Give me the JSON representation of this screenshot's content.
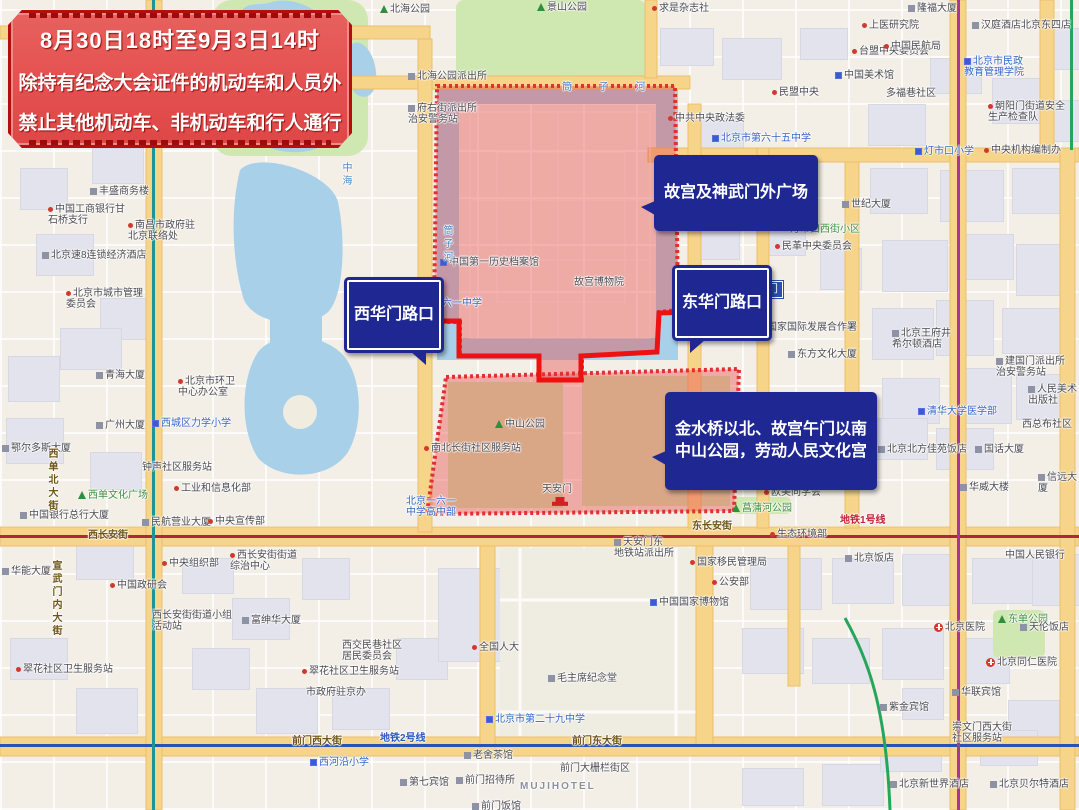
{
  "banner": {
    "line1": "8月30日18时至9月3日14时",
    "line2": "除持有纪念大会证件的机动车和人员外",
    "line3": "禁止其他机动车、非机动车和行人通行"
  },
  "callouts": {
    "xihuamen": "西华门路口",
    "donghuamen": "东华门路口",
    "gugong": "故宫及神武门外广场",
    "jinshui": "金水桥以北、故宫午门以南\n中山公园，劳动人民文化宫"
  },
  "colors": {
    "zone": "#e84c4c",
    "route": "#ee1111",
    "water": "#a9d0e9",
    "park": "#cfe7b0",
    "road": "#f6d489",
    "bubble": "#1e2792",
    "metro1": "#b0273a",
    "metro2": "#2a52b0",
    "metro4": "#1f939b",
    "metro5": "#a23a91",
    "metro8": "#26a65b"
  },
  "plates": [
    {
      "t": "东华门",
      "x": 740,
      "y": 281
    }
  ],
  "map": {
    "labels": [
      {
        "t": "求是杂志社",
        "x": 652,
        "y": 3,
        "ic": "dot"
      },
      {
        "t": "北海公园",
        "x": 380,
        "y": 4,
        "ic": "tree"
      },
      {
        "t": "景山公园",
        "x": 537,
        "y": 2,
        "ic": "tree"
      },
      {
        "t": "上医研究院",
        "x": 862,
        "y": 20,
        "ic": "dot"
      },
      {
        "t": "台盟中央委员会",
        "x": 852,
        "y": 46,
        "ic": "dot"
      },
      {
        "t": "隆福大厦",
        "x": 908,
        "y": 3,
        "ic": "gbld"
      },
      {
        "t": "汉庭酒店北京东四店",
        "x": 972,
        "y": 20,
        "ic": "gbld"
      },
      {
        "t": "中国民航局",
        "x": 884,
        "y": 41,
        "ic": "dot"
      },
      {
        "t": "民盟中央",
        "x": 772,
        "y": 87,
        "ic": "dot"
      },
      {
        "t": "中共中央政法委",
        "x": 668,
        "y": 113,
        "ic": "dot"
      },
      {
        "t": "北京市第六十五中学",
        "x": 712,
        "y": 133,
        "c": "blue",
        "ic": "bld"
      },
      {
        "t": "北海公园派出所",
        "x": 408,
        "y": 71,
        "ic": "gbld"
      },
      {
        "t": "筒 子 河",
        "x": 562,
        "y": 82,
        "c": "water",
        "ls": 12
      },
      {
        "t": "中国美术馆",
        "x": 835,
        "y": 70,
        "ic": "bld"
      },
      {
        "t": "多福巷社区",
        "x": 886,
        "y": 88
      },
      {
        "t": "北京市民政\n教育管理学院",
        "x": 964,
        "y": 56,
        "c": "blue",
        "ic": "bld"
      },
      {
        "t": "朝阳门街道安全\n生产检查队",
        "x": 988,
        "y": 101,
        "ic": "dot"
      },
      {
        "t": "灯市口小学",
        "x": 915,
        "y": 146,
        "c": "blue",
        "ic": "bld"
      },
      {
        "t": "中央机构编制办",
        "x": 984,
        "y": 145,
        "ic": "dot"
      },
      {
        "t": "北京王府井西华\n智选饭店",
        "x": 700,
        "y": 200,
        "ic": "gbld"
      },
      {
        "t": "世纪大厦",
        "x": 842,
        "y": 199,
        "ic": "gbld"
      },
      {
        "t": "灯市口西街小区",
        "x": 790,
        "y": 224,
        "c": "green"
      },
      {
        "t": "民革中央委员会",
        "x": 775,
        "y": 241,
        "ic": "dot"
      },
      {
        "t": "中国第一历史档案馆",
        "x": 440,
        "y": 257,
        "ic": "bld"
      },
      {
        "t": "故宫博物院",
        "x": 574,
        "y": 277
      },
      {
        "t": "北京一六一中学",
        "x": 412,
        "y": 298,
        "c": "blue"
      },
      {
        "t": "筒子河",
        "x": 441,
        "y": 225,
        "c": "water",
        "v": 1
      },
      {
        "t": "中海",
        "x": 340,
        "y": 162,
        "c": "water",
        "v": 1
      },
      {
        "t": "府右街派出所\n治安警务站",
        "x": 408,
        "y": 103,
        "ic": "gbld"
      },
      {
        "t": "国家国际发展合作署",
        "x": 760,
        "y": 322,
        "ic": "dot"
      },
      {
        "t": "东方文化大厦",
        "x": 788,
        "y": 349,
        "ic": "gbld"
      },
      {
        "t": "北京王府井\n希尔顿酒店",
        "x": 892,
        "y": 328,
        "ic": "gbld"
      },
      {
        "t": "建国门派出所\n治安警务站",
        "x": 996,
        "y": 356,
        "ic": "gbld"
      },
      {
        "t": "人民美术出版社",
        "x": 1028,
        "y": 384,
        "ic": "gbld"
      },
      {
        "t": "清华大学医学部",
        "x": 918,
        "y": 406,
        "c": "blue",
        "ic": "bld"
      },
      {
        "t": "西总布社区",
        "x": 1022,
        "y": 419
      },
      {
        "t": "北京北方佳苑饭店",
        "x": 878,
        "y": 444,
        "ic": "gbld"
      },
      {
        "t": "国话大厦",
        "x": 975,
        "y": 444,
        "ic": "gbld"
      },
      {
        "t": "华威大楼",
        "x": 960,
        "y": 482,
        "ic": "gbld"
      },
      {
        "t": "信远大厦",
        "x": 1038,
        "y": 472,
        "ic": "gbld"
      },
      {
        "t": "丰盛商务楼",
        "x": 90,
        "y": 186,
        "ic": "gbld"
      },
      {
        "t": "中国工商银行甘\n石桥支行",
        "x": 48,
        "y": 204,
        "ic": "dot"
      },
      {
        "t": "南昌市政府驻\n北京联络处",
        "x": 128,
        "y": 220,
        "ic": "dot"
      },
      {
        "t": "北京速8连锁经济酒店",
        "x": 42,
        "y": 250,
        "ic": "gbld"
      },
      {
        "t": "北京市城市管理\n委员会",
        "x": 66,
        "y": 288,
        "ic": "dot"
      },
      {
        "t": "青海大厦",
        "x": 96,
        "y": 370,
        "ic": "gbld"
      },
      {
        "t": "北京市环卫\n中心办公室",
        "x": 178,
        "y": 376,
        "ic": "dot"
      },
      {
        "t": "广州大厦",
        "x": 96,
        "y": 420,
        "ic": "gbld"
      },
      {
        "t": "西城区力学小学",
        "x": 152,
        "y": 418,
        "c": "blue",
        "ic": "bld"
      },
      {
        "t": "鄂尔多斯大厦",
        "x": 2,
        "y": 443,
        "ic": "gbld"
      },
      {
        "t": "钟声社区服务站",
        "x": 142,
        "y": 462
      },
      {
        "t": "工业和信息化部",
        "x": 174,
        "y": 483,
        "ic": "dot"
      },
      {
        "t": "西单文化广场",
        "x": 78,
        "y": 490,
        "c": "green",
        "ic": "tree"
      },
      {
        "t": "中国银行总行大厦",
        "x": 20,
        "y": 510,
        "ic": "gbld"
      },
      {
        "t": "民航营业大厦",
        "x": 142,
        "y": 517,
        "ic": "gbld"
      },
      {
        "t": "中央宣传部",
        "x": 208,
        "y": 516,
        "ic": "dot"
      },
      {
        "t": "西长安街",
        "x": 88,
        "y": 530,
        "c": "road"
      },
      {
        "t": "华能大厦",
        "x": 2,
        "y": 566,
        "ic": "gbld"
      },
      {
        "t": "中央组织部",
        "x": 162,
        "y": 558,
        "ic": "dot"
      },
      {
        "t": "西长安街街道\n综治中心",
        "x": 230,
        "y": 550,
        "ic": "dot"
      },
      {
        "t": "中国政研会",
        "x": 110,
        "y": 580,
        "ic": "dot"
      },
      {
        "t": "宣武门内大街",
        "x": 50,
        "y": 560,
        "c": "road",
        "v": 1
      },
      {
        "t": "西单北大街",
        "x": 46,
        "y": 448,
        "c": "road",
        "v": 1
      },
      {
        "t": "西长安街街道小组\n活动站",
        "x": 152,
        "y": 610
      },
      {
        "t": "富绅华大厦",
        "x": 242,
        "y": 615,
        "ic": "gbld"
      },
      {
        "t": "翠花社区卫生服务站",
        "x": 16,
        "y": 664,
        "ic": "dot"
      },
      {
        "t": "翠花社区卫生服务站",
        "x": 302,
        "y": 666,
        "ic": "dot"
      },
      {
        "t": "西交民巷社区\n居民委员会",
        "x": 342,
        "y": 640
      },
      {
        "t": "市政府驻京办",
        "x": 306,
        "y": 687
      },
      {
        "t": "全国人大",
        "x": 472,
        "y": 642,
        "ic": "dot"
      },
      {
        "t": "毛主席纪念堂",
        "x": 548,
        "y": 673,
        "ic": "gbld"
      },
      {
        "t": "北京市第二十九中学",
        "x": 486,
        "y": 714,
        "c": "blue",
        "ic": "bld"
      },
      {
        "t": "前门西大街",
        "x": 292,
        "y": 736,
        "c": "road"
      },
      {
        "t": "地铁2号线",
        "x": 380,
        "y": 733,
        "c": "m2"
      },
      {
        "t": "前门东大街",
        "x": 572,
        "y": 736,
        "c": "road"
      },
      {
        "t": "老舍茶馆",
        "x": 464,
        "y": 750,
        "ic": "gbld"
      },
      {
        "t": "西河沿小学",
        "x": 310,
        "y": 757,
        "c": "blue",
        "ic": "bld"
      },
      {
        "t": "第七宾馆",
        "x": 400,
        "y": 777,
        "ic": "gbld"
      },
      {
        "t": "前门招待所",
        "x": 456,
        "y": 775,
        "ic": "gbld"
      },
      {
        "t": "MUJIHOTEL",
        "x": 520,
        "y": 781,
        "c": "latin"
      },
      {
        "t": "前门大栅栏街区",
        "x": 560,
        "y": 763
      },
      {
        "t": "前门饭馆",
        "x": 472,
        "y": 801,
        "ic": "gbld"
      },
      {
        "t": "中山公园",
        "x": 495,
        "y": 419,
        "ic": "tree"
      },
      {
        "t": "南北长街社区服务站",
        "x": 424,
        "y": 443,
        "ic": "dot"
      },
      {
        "t": "天安门",
        "x": 542,
        "y": 484
      },
      {
        "t": "",
        "x": 552,
        "y": 496,
        "ic": "gate"
      },
      {
        "t": "北京一六一\n中学高中部",
        "x": 406,
        "y": 496,
        "c": "blue"
      },
      {
        "t": "菖蒲河公园",
        "x": 732,
        "y": 503,
        "c": "green",
        "ic": "tree"
      },
      {
        "t": "欧美同学会",
        "x": 764,
        "y": 487,
        "ic": "dot"
      },
      {
        "t": "生态环境部",
        "x": 770,
        "y": 529,
        "ic": "dot"
      },
      {
        "t": "天安门东\n地铁站派出所",
        "x": 614,
        "y": 537,
        "ic": "gbld"
      },
      {
        "t": "国家移民管理局",
        "x": 690,
        "y": 557,
        "ic": "dot"
      },
      {
        "t": "公安部",
        "x": 712,
        "y": 577,
        "ic": "dot"
      },
      {
        "t": "中国国家博物馆",
        "x": 650,
        "y": 597,
        "ic": "bld"
      },
      {
        "t": "东长安街",
        "x": 692,
        "y": 521,
        "c": "road"
      },
      {
        "t": "地铁1号线",
        "x": 840,
        "y": 515,
        "c": "m1"
      },
      {
        "t": "北京饭店",
        "x": 845,
        "y": 553,
        "ic": "gbld"
      },
      {
        "t": "中国人民银行",
        "x": 1005,
        "y": 550
      },
      {
        "t": "东单公园",
        "x": 998,
        "y": 614,
        "c": "green",
        "ic": "tree"
      },
      {
        "t": "北京医院",
        "x": 934,
        "y": 622,
        "ic": "cross"
      },
      {
        "t": "天伦饭店",
        "x": 1020,
        "y": 622,
        "ic": "gbld"
      },
      {
        "t": "北京同仁医院",
        "x": 986,
        "y": 657,
        "ic": "cross"
      },
      {
        "t": "华联宾馆",
        "x": 952,
        "y": 687,
        "ic": "gbld"
      },
      {
        "t": "紫金宾馆",
        "x": 880,
        "y": 702,
        "ic": "gbld"
      },
      {
        "t": "崇文门西大街\n社区服务站",
        "x": 952,
        "y": 722
      },
      {
        "t": "北京新世界酒店",
        "x": 890,
        "y": 779,
        "ic": "gbld"
      },
      {
        "t": "北京贝尔特酒店",
        "x": 990,
        "y": 779,
        "ic": "gbld"
      }
    ]
  }
}
